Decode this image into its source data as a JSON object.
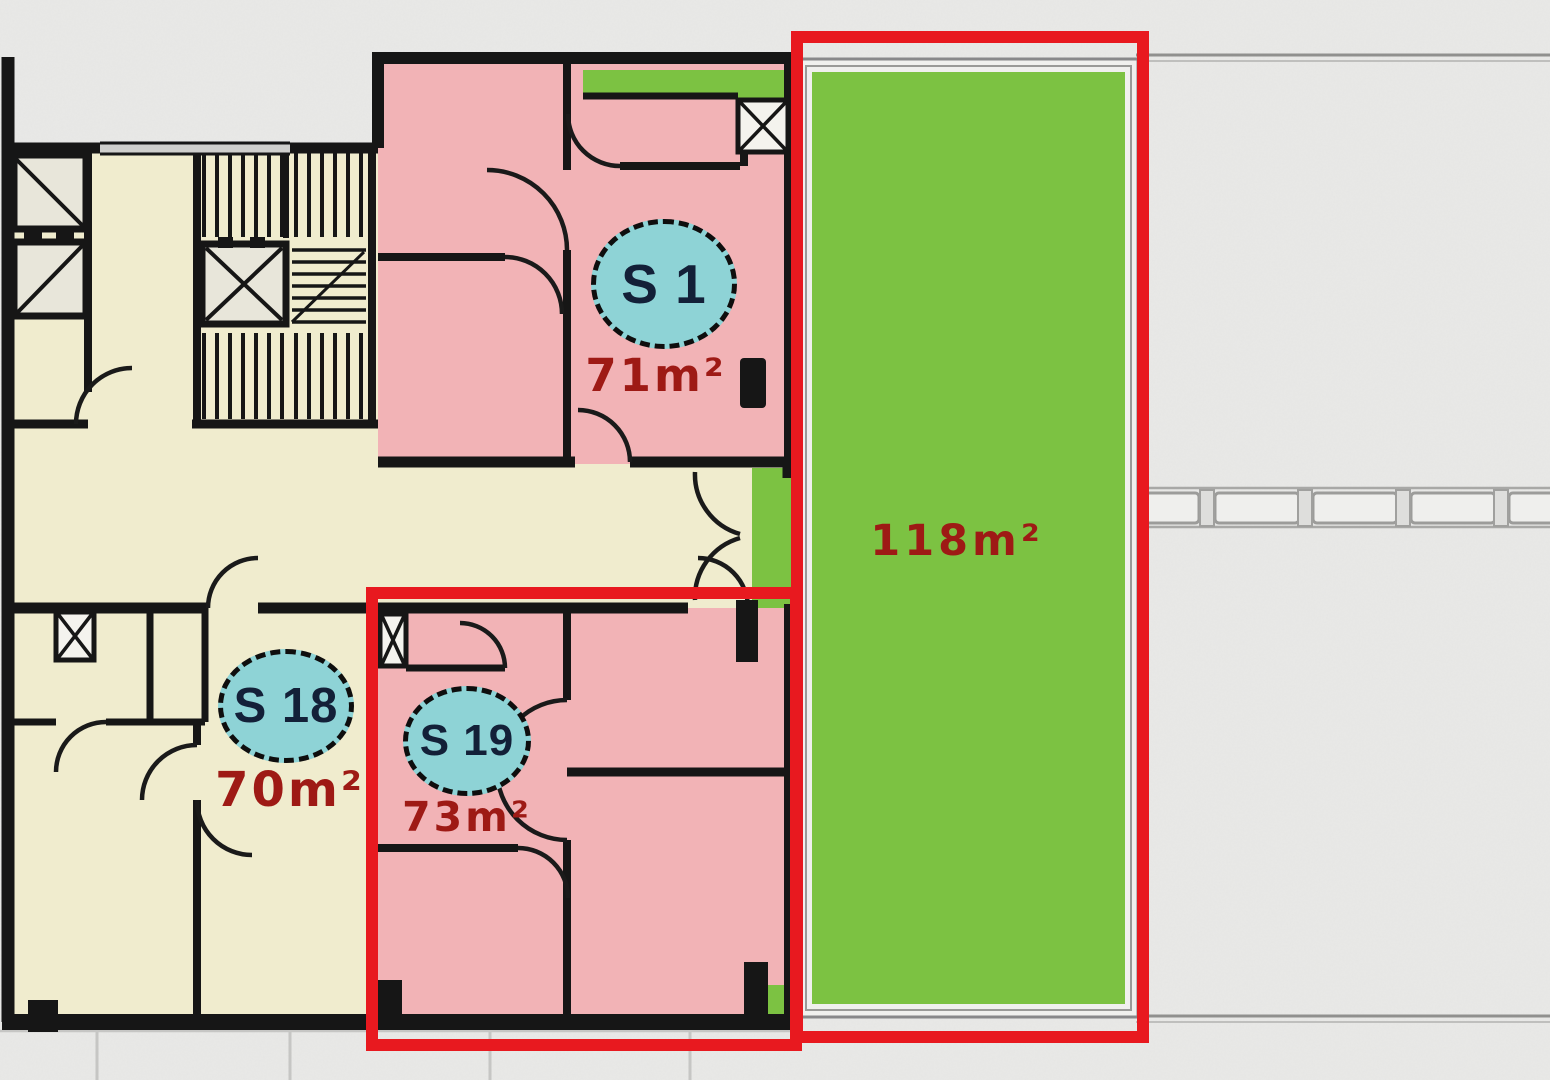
{
  "plan": {
    "type": "apartment-floor-plan",
    "units": [
      {
        "id": "S 1",
        "area": "71m²",
        "fill": "pink",
        "highlighted": false
      },
      {
        "id": "S 18",
        "area": "70m²",
        "fill": "cream",
        "highlighted": false
      },
      {
        "id": "S 19",
        "area": "73m²",
        "fill": "pink",
        "highlighted": true
      }
    ],
    "terrace": {
      "area": "118m²",
      "highlighted": true
    }
  },
  "colors": {
    "highlight_red": "#e8191f",
    "terrace_green": "#7cc242",
    "apartment_pink": "#f2b3b6",
    "common_cream": "#f0ecce",
    "shaft_gray": "#e8e6da",
    "badge_cyan": "#8ed3d6",
    "badge_text": "#132038",
    "area_text_red": "#9e1a15",
    "wall_black": "#161616",
    "background_gray": "#e9e9e7",
    "paving_line_gray": "#90908e"
  }
}
